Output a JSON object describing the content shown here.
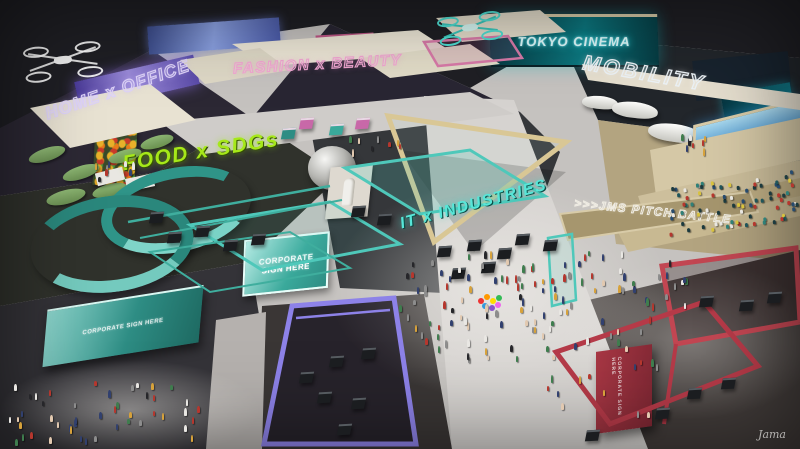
{
  "title": "exhibition-hall-concept-render",
  "zones": {
    "home_office": {
      "label": "HOME x OFFICE",
      "color": "#ddd2f8"
    },
    "fashion_beauty": {
      "label": "FASHION x BEAUTY",
      "color": "#f2a6d2"
    },
    "tokyo_cinema": {
      "label": "TOKYO CINEMA",
      "color": "#57e6d8"
    },
    "mobility": {
      "label": "MOBILITY",
      "color": "#edf3f7"
    },
    "food_sdgs": {
      "label": "FOOD x SDGs",
      "color": "#a6e819"
    },
    "it_industries": {
      "label": "IT x INDUSTRIES",
      "color": "#57e6d8"
    },
    "pitch_battle": {
      "label": ">>>JMS PITCH BATTLE",
      "color": "#f0ede4"
    }
  },
  "signs": {
    "corporate_line1": "CORPORATE",
    "corporate_line2": "SIGN HERE",
    "corporate_small": "CORPORATE SIGN HERE"
  },
  "watermark": "Jama"
}
